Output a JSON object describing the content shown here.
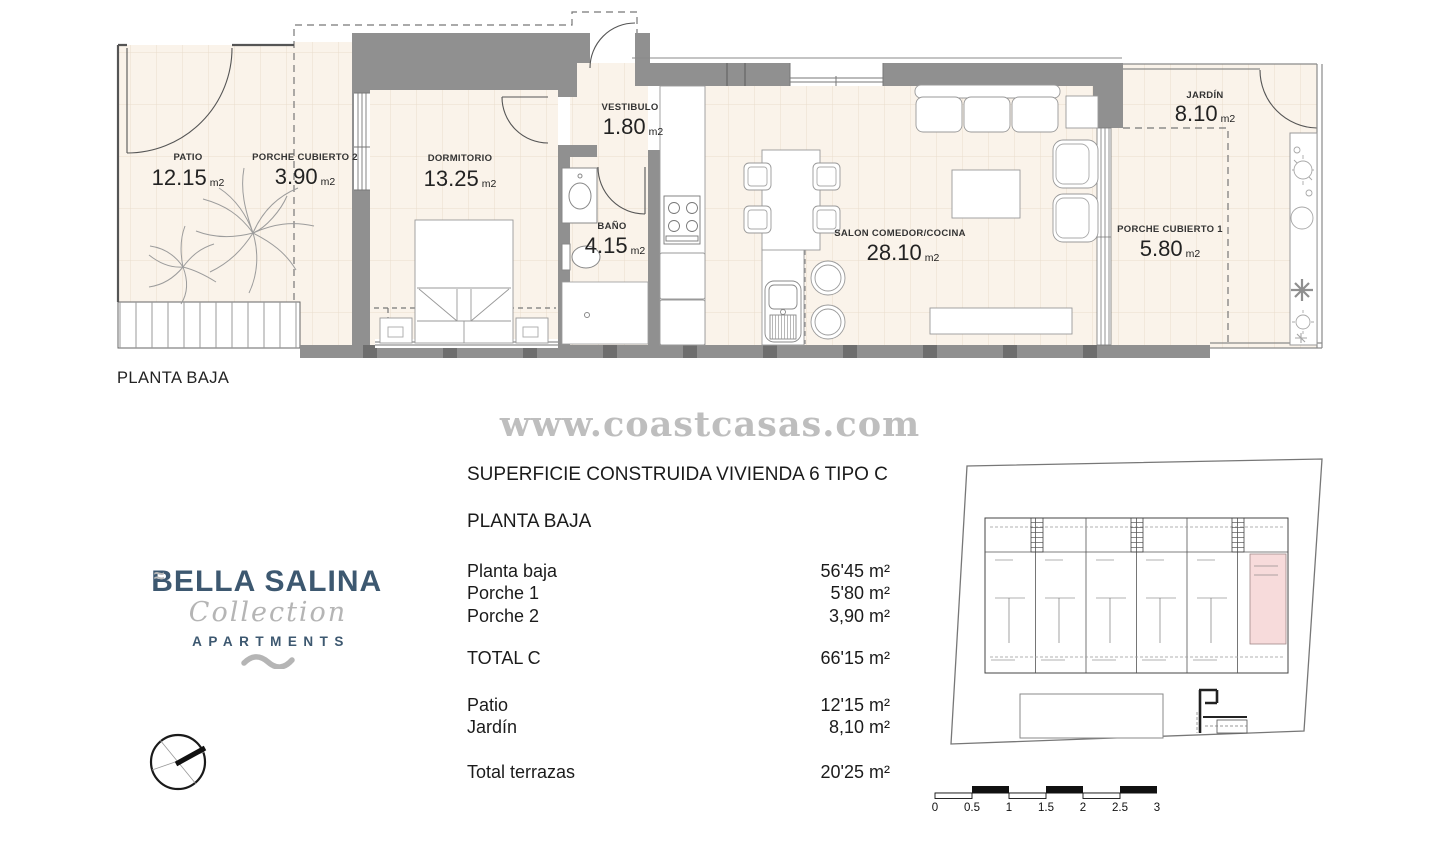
{
  "plan": {
    "caption": "PLANTA BAJA",
    "rooms": {
      "patio": {
        "name": "PATIO",
        "area": "12.15",
        "unit": "m2"
      },
      "porche2": {
        "name": "PORCHE CUBIERTO 2",
        "area": "3.90",
        "unit": "m2"
      },
      "dormitorio": {
        "name": "DORMITORIO",
        "area": "13.25",
        "unit": "m2"
      },
      "vestibulo": {
        "name": "VESTIBULO",
        "area": "1.80",
        "unit": "m2"
      },
      "bano": {
        "name": "BAÑO",
        "area": "4.15",
        "unit": "m2"
      },
      "salon": {
        "name": "SALON COMEDOR/COCINA",
        "area": "28.10",
        "unit": "m2"
      },
      "jardin": {
        "name": "JARDÍN",
        "area": "8.10",
        "unit": "m2"
      },
      "porche1": {
        "name": "PORCHE CUBIERTO 1",
        "area": "5.80",
        "unit": "m2"
      }
    }
  },
  "watermark": "www.coastcasas.com",
  "summary": {
    "title": "SUPERFICIE CONSTRUIDA VIVIENDA 6 TIPO C",
    "subtitle": "PLANTA BAJA",
    "rows": [
      {
        "label": "Planta baja",
        "value": "56'45 m²"
      },
      {
        "label": "Porche 1",
        "value": "5'80 m²"
      },
      {
        "label": "Porche 2",
        "value": "3,90 m²"
      }
    ],
    "total": {
      "label": "TOTAL C",
      "value": "66'15 m²"
    },
    "terrace_rows": [
      {
        "label": "Patio",
        "value": "12'15 m²"
      },
      {
        "label": "Jardín",
        "value": "8,10 m²"
      }
    ],
    "terrace_total": {
      "label": "Total terrazas",
      "value": "20'25 m²"
    }
  },
  "logo": {
    "wave": "≈",
    "brand": "BELLA SALINA",
    "collection": "Collection",
    "type": "APARTMENTS"
  },
  "scalebar": {
    "labels": [
      "0",
      "0.5",
      "1",
      "1.5",
      "2",
      "2.5",
      "3"
    ]
  },
  "colors": {
    "floor": "#faf3ea",
    "wall_gray": "#909090",
    "wall_dark": "#6e6e6e",
    "navy": "#3d5870",
    "script_gray": "#b5b5b5",
    "watermark_gray": "#b3b3b3",
    "highlight_pink": "#f7dbdb"
  }
}
